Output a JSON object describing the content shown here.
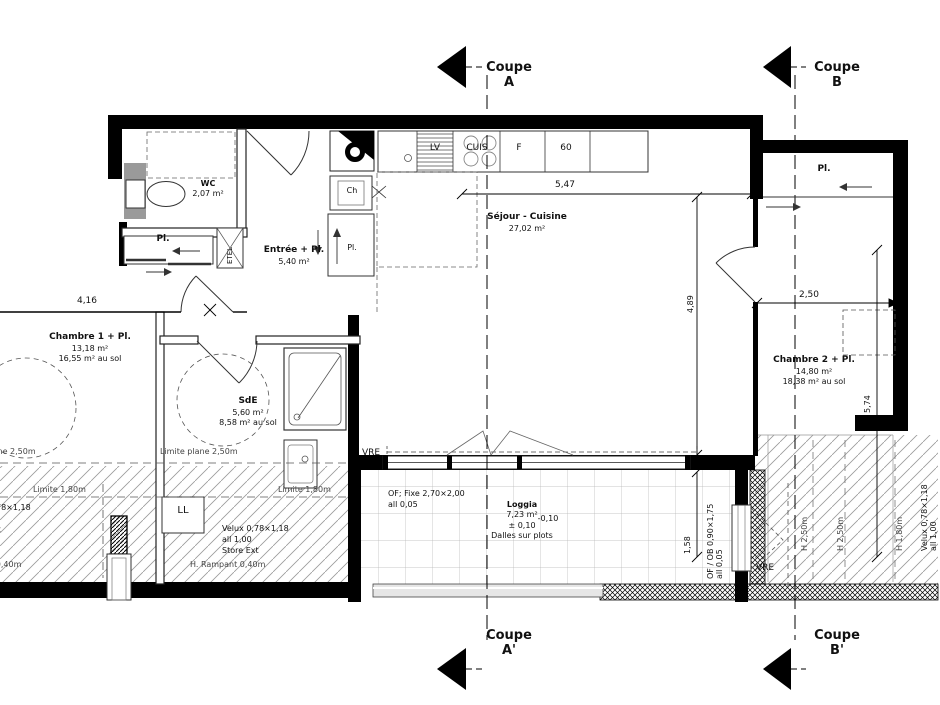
{
  "sections": {
    "a_top": {
      "line1": "Coupe",
      "line2": "A"
    },
    "b_top": {
      "line1": "Coupe",
      "line2": "B"
    },
    "a_bottom": {
      "line1": "Coupe",
      "line2": "A'"
    },
    "b_bottom": {
      "line1": "Coupe",
      "line2": "B'"
    }
  },
  "rooms": {
    "wc": {
      "name": "WC",
      "area": "2,07 m²"
    },
    "sejour": {
      "name": "Séjour - Cuisine",
      "area": "27,02 m²"
    },
    "entree": {
      "name": "Entrée + Pl.",
      "area": "5,40 m²"
    },
    "chambre1": {
      "name": "Chambre 1 + Pl.",
      "area": "13,18 m²",
      "floor": "16,55 m² au sol"
    },
    "sde": {
      "name": "SdE",
      "area": "5,60 m²",
      "floor": "8,58 m² au sol"
    },
    "chambre2": {
      "name": "Chambre 2 + Pl.",
      "area": "14,80 m²",
      "floor": "18,38 m² au sol"
    },
    "loggia": {
      "name": "Loggia",
      "area": "7,23 m²",
      "level": "-0,10",
      "level2": "± 0,10",
      "note": "Dalles sur plots"
    }
  },
  "kitchen": {
    "lv": "LV",
    "cuis": "CUIS",
    "f": "F",
    "s60": "60",
    "ch": "Ch"
  },
  "closets": {
    "pl": "Pl.",
    "etel": "ETEL",
    "ll": "LL"
  },
  "dimensions": {
    "d547": "5,47",
    "d416": "4,16",
    "d489": "4,89",
    "d250": "2,50",
    "d574": "5,74",
    "d158": "1,58"
  },
  "limits": {
    "plane": "Limite plane 2,50m",
    "l180": "Limite 1,80m",
    "rampant": "H. Rampant 0,40m",
    "h250": "H 2,50m",
    "h180": "H 1,80m"
  },
  "windows": {
    "velux": {
      "l1": "Velux 0,78×1,18",
      "l2": "all 1,00",
      "l3": "Store Ext"
    },
    "bay": {
      "l1": "OF; Fixe 2,70×2,00",
      "l2": "all 0,05"
    },
    "door_window": {
      "l1": "OF / OB 0,90×1,75",
      "l2": "all 0,05"
    },
    "vre": "VRE"
  },
  "colors": {
    "wall": "#000000",
    "background": "#ffffff"
  }
}
